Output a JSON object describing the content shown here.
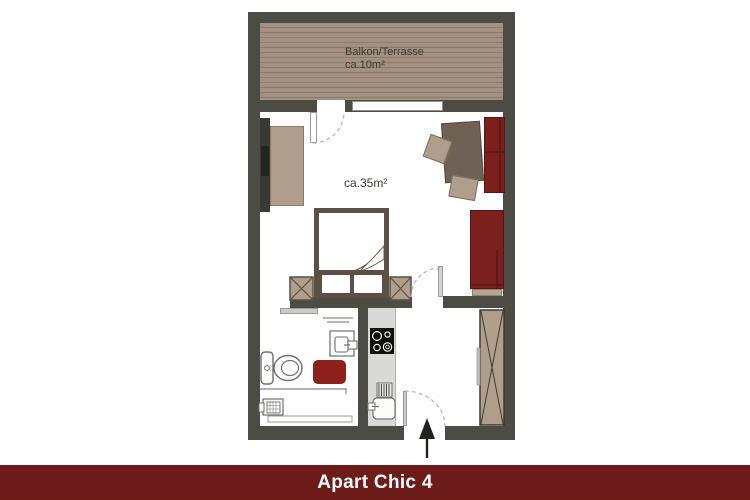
{
  "banner": {
    "title": "Apart Chic 4"
  },
  "floorplan": {
    "balcony": {
      "name": "Balkon/Terrasse",
      "area": "ca.10m²"
    },
    "living_room": {
      "area": "ca.35m²"
    }
  },
  "colors": {
    "wall": "#4c4c44",
    "banner-bg": "#6e1c19",
    "banner-text": "#ffffff",
    "accent-red": "#7b201c",
    "accent-red-dark": "#581512",
    "mat-red": "#8e211c",
    "deck": "#a29080",
    "deck-line": "#8d7b6d",
    "furniture-tan": "#b09e8c",
    "furniture-dark": "#6f6156",
    "bed-frame": "#5c4f44",
    "counter": "#d9d9d7",
    "label-text": "#3b3b35"
  }
}
